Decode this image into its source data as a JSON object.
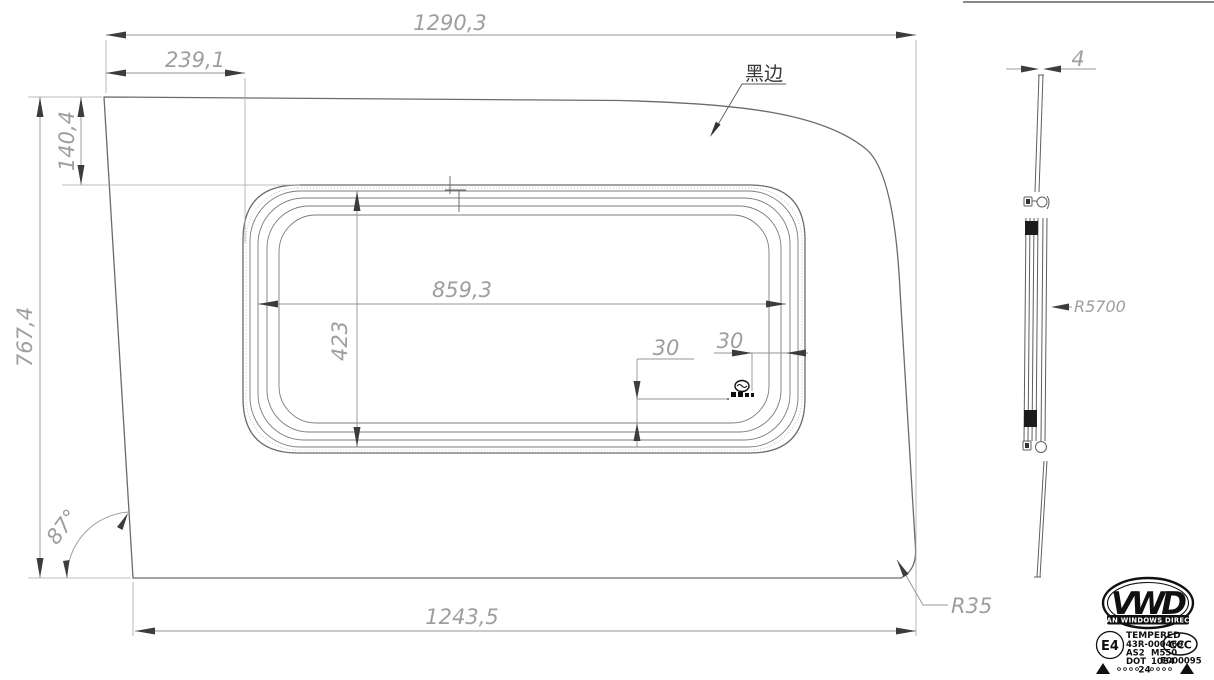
{
  "title": "Van window tempered glass technical drawing",
  "dimensions": {
    "overall_width": "1290,3",
    "left_to_opening": "239,1",
    "top_band_height": "140,4",
    "overall_height": "767,4",
    "opening_width": "859,3",
    "opening_height": "423",
    "stamp_offset_v": "30",
    "stamp_offset_h": "30",
    "bottom_width": "1243,5",
    "corner_angle": "87°",
    "corner_radius": "R35",
    "glass_thickness": "4",
    "bend_radius": "R5700"
  },
  "annotations": {
    "black_edge_label": "黑边"
  },
  "certification": {
    "brand_initials": "VWD",
    "brand_name": "VAN WINDOWS DIRECT",
    "e_mark": "E4",
    "tempered": "TEMPERED",
    "approval_no": "43R-000469",
    "as_code": "AS2",
    "model_code": "M550",
    "dot_label": "DOT",
    "dot_no": "1084",
    "ccc_mark": "CCC",
    "ccc_no": "E000095",
    "year_code": "24"
  },
  "colors": {
    "outline": "#6b6b6b",
    "dimension": "#9e9e9e",
    "hatch": "#c6c6c6",
    "ink": "#101010",
    "background": "#ffffff"
  }
}
